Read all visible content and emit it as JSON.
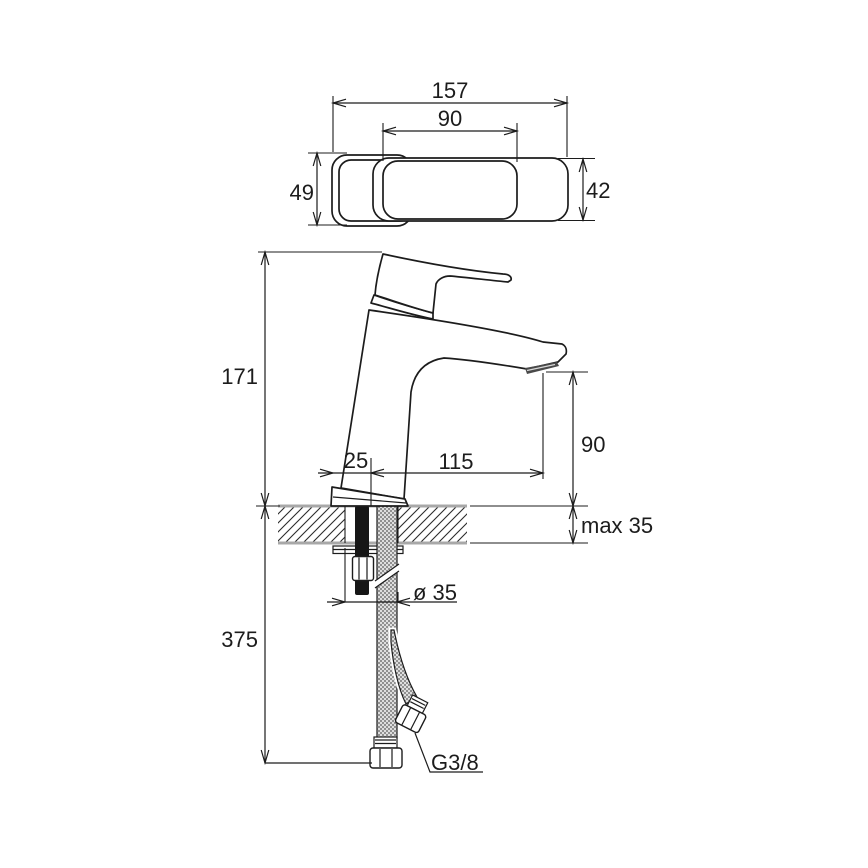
{
  "drawing": {
    "type": "technical-dimension-drawing",
    "subject": "single-lever basin mixer faucet with top view, side elevation, countertop cross-section and flexible supply hoses",
    "units": "mm"
  },
  "dimensions": {
    "plan_overall_length": "157",
    "plan_lever_length": "90",
    "plan_handle_width": "49",
    "plan_body_width": "42",
    "height_total": "171",
    "spout_height": "90",
    "axis_offset": "25",
    "spout_reach": "115",
    "deck_thickness_max": "max 35",
    "below_deck_length": "375",
    "hole_diameter": "ø 35",
    "hose_thread": "G3/8"
  },
  "colors": {
    "line": "#1c1c1c",
    "deck_edge": "#a8a8a8",
    "hose_braid": "#9b9b9b",
    "aerator": "#4a4a4a",
    "background": "#ffffff"
  }
}
